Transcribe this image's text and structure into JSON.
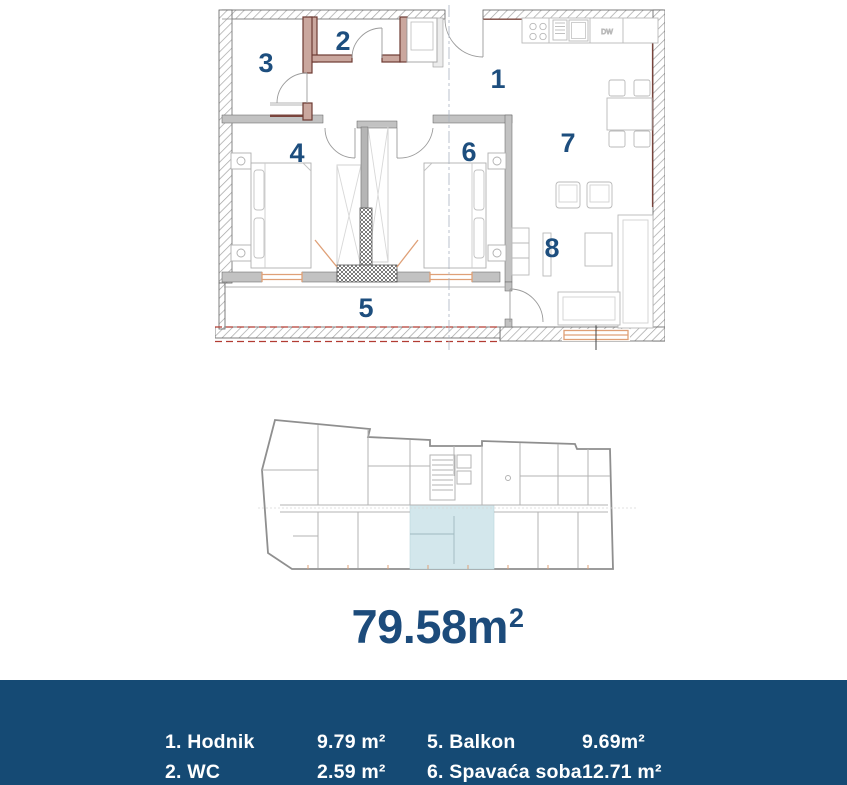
{
  "plan": {
    "room_numbers": [
      "1",
      "2",
      "3",
      "4",
      "5",
      "6",
      "7",
      "8"
    ],
    "dw_label": "DW"
  },
  "area": {
    "value": "79.58m",
    "sup": "2"
  },
  "legend": {
    "rows": [
      {
        "c1": "1. Hodnik",
        "c2": "9.79 m²",
        "c3": "5. Balkon",
        "c4": "9.69m²"
      },
      {
        "c1": "2. WC",
        "c2": "2.59 m²",
        "c3": "6. Spavaća soba",
        "c4": "12.71 m²"
      }
    ]
  },
  "colors": {
    "accent_navy": "#1c4b7b",
    "room_number_blue": "#1d4e7e",
    "footer_bg": "#154a74",
    "unit_highlight": "#d3e7ec",
    "wall_red": "#6d3b33",
    "window_orange": "#dfa077",
    "dashed_red": "#b23c33"
  }
}
